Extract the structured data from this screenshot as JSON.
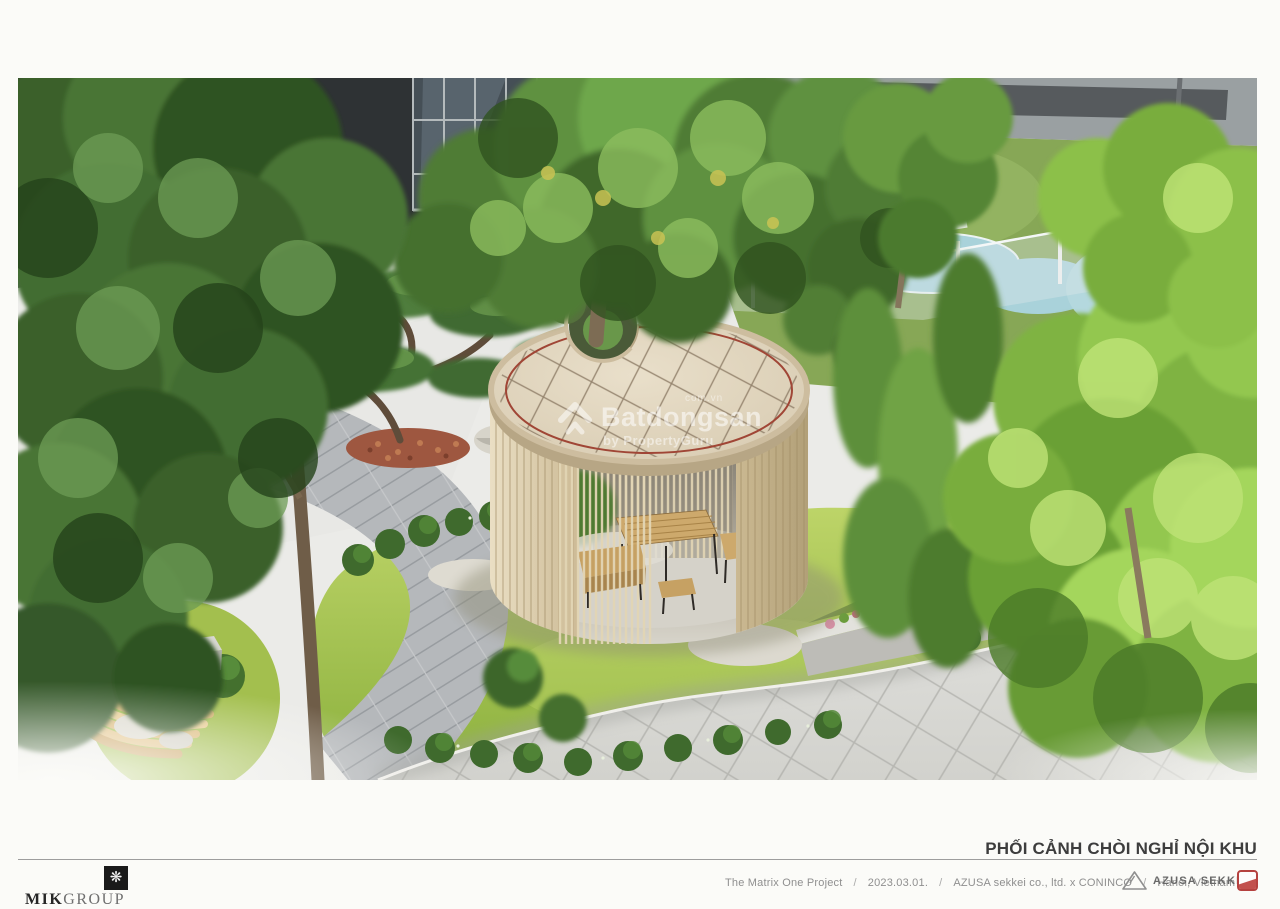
{
  "page": {
    "background": "#fbfbf8",
    "width": 1280,
    "height": 906
  },
  "artwork": {
    "type": "architectural-rendering",
    "alt": "Aerial 3D rendering of a residential inner courtyard: circular timber rest pavilion with tiled round roof pierced by a tree, rattan table set inside, curved grey paved paths, lawns, clipped hedges, bonsai tree, curved wooden bench, kids pool and playground behind a glass fence, dark glazed building facade at top",
    "watermark": {
      "brand": "Batdongsan",
      "suffix": "com.vn",
      "byline": "by PropertyGuru"
    }
  },
  "caption": {
    "title": "PHỐI CẢNH CHÒI NGHỈ NỘI KHU"
  },
  "footer": {
    "slash": "/",
    "segments": [
      "The Matrix One Project",
      "2023.03.01.",
      "AZUSA sekkei co., ltd. x CONINCO",
      "Hanoi, Vietnam"
    ],
    "mik": {
      "bold": "MIK",
      "light": "GROUP",
      "mark": "❋"
    },
    "azusa": {
      "label": "AZUSA SEKKEI"
    }
  },
  "colors": {
    "page_bg": "#fbfbf8",
    "title_text": "#3d3d3d",
    "footer_text": "#8f8f8f",
    "rule_line": "#9d9d9d",
    "stamp_red": "#b5413f",
    "roof_tile": "#ddd0ba",
    "roof_trim_red": "#a04636",
    "pavilion_wood": "#d6c7a6",
    "lawn_green": "#9cba4a",
    "tree_dark_green": "#3f682e",
    "tree_bright_green": "#8cc04a",
    "pool_blue": "#a9d2da",
    "path_grey": "#b6b9bc",
    "plaza_grey": "#d9d9d5",
    "facade_dark": "#2e3234"
  }
}
